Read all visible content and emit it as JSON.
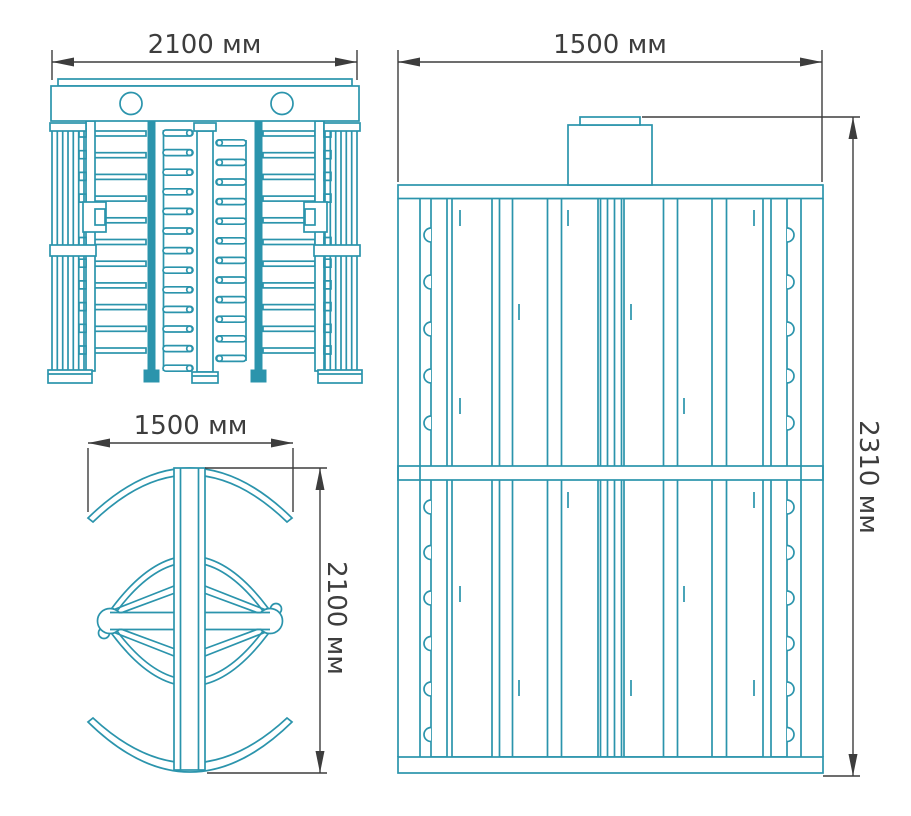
{
  "colors": {
    "drawing_line": "#2b94ac",
    "dimension_line": "#3d3d3d",
    "background": "#ffffff"
  },
  "views": {
    "front": {
      "width_label": "2100 мм"
    },
    "plan": {
      "width_label": "1500 мм",
      "depth_label": "2100 мм"
    },
    "side": {
      "width_label": "1500 мм",
      "height_label": "2310 мм"
    }
  }
}
